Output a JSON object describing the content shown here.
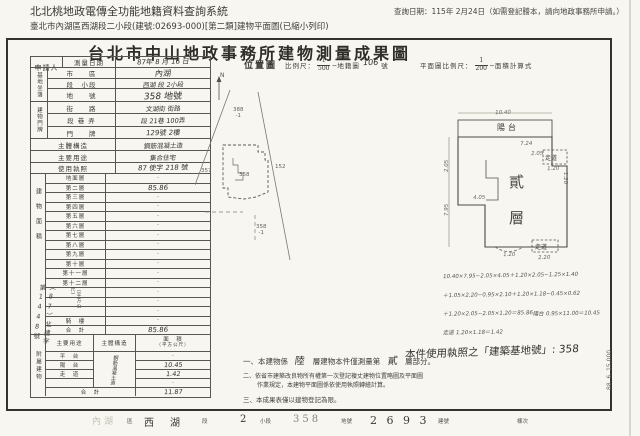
{
  "colors": {
    "ink": "#34322c",
    "paper": "#f7f6f1",
    "line": "#5a564d"
  },
  "page": {
    "system_title": "北北桃地政電傳全功能地籍資料查詢系統",
    "query_date": "查詢日期：115年 2月24日（如需登記謄本，請向地政事務所申請。）",
    "print_line": "臺北市內湖區西湖段二小段(建號:02693-000)[第二類]建物平面圖(已縮小列印)",
    "form_code": "88. 6. 15,000"
  },
  "title": "台北市中山地政事務所建物測量成果圖",
  "info": {
    "applicant_label": "申請人",
    "survey_date_label": "測量日期",
    "survey_date": "87年 8 月 16 日",
    "site_group": "基地坐落",
    "city_label": "市　　區",
    "city": "內湖",
    "section_label": "段　小段",
    "section": "西湖 段 2小段",
    "parcel_label": "地　　號",
    "parcel": "358 地號",
    "door_group": "建物門牌",
    "street_label": "街　　路",
    "street": "文湖街 街路",
    "lane_label": "段 巷 弄",
    "lane": "段 21巷 100弄",
    "door_label": "門　　牌",
    "door": "129號 2樓",
    "structure_label": "主體構造",
    "structure": "鋼筋混凝土造",
    "use_label": "主要用途",
    "use": "集合住宅",
    "license_label": "使用執照",
    "license": "87 使字 218 號"
  },
  "floors": {
    "group": "建物面積",
    "unit": "（平方公尺）",
    "stamp": "（87）北建字第1448號",
    "rows": [
      {
        "label": "地面層",
        "value": "·",
        "hand": false
      },
      {
        "label": "第二層",
        "value": "85.86",
        "hand": true
      },
      {
        "label": "第三層",
        "value": "·",
        "hand": false
      },
      {
        "label": "第四層",
        "value": "·",
        "hand": false
      },
      {
        "label": "第五層",
        "value": "·",
        "hand": false
      },
      {
        "label": "第六層",
        "value": "·",
        "hand": false
      },
      {
        "label": "第七層",
        "value": "·",
        "hand": false
      },
      {
        "label": "第八層",
        "value": "·",
        "hand": false
      },
      {
        "label": "第九層",
        "value": "·",
        "hand": false
      },
      {
        "label": "第十層",
        "value": "·",
        "hand": false
      },
      {
        "label": "第十一層",
        "value": "·",
        "hand": false
      },
      {
        "label": "第十二層",
        "value": "·",
        "hand": false
      },
      {
        "label": "",
        "value": "·",
        "hand": false
      },
      {
        "label": "",
        "value": "·",
        "hand": false
      },
      {
        "label": "",
        "value": "·",
        "hand": false
      },
      {
        "label": "騎　樓",
        "value": "·",
        "hand": false
      },
      {
        "label": "合　計",
        "value": "85.86",
        "hand": true
      }
    ]
  },
  "attached": {
    "group": "附屬建物",
    "headers": [
      "主要用途",
      "主體構造",
      "面　積"
    ],
    "area_unit": "（平方公尺）",
    "structure_vertical": "鋼筋混凝土造",
    "rows": [
      {
        "use": "平　台",
        "value": "·",
        "hand": false
      },
      {
        "use": "陽　台",
        "value": "10.45",
        "hand": true
      },
      {
        "use": "走　道",
        "value": "1.42",
        "hand": true
      },
      {
        "use": "",
        "value": "·",
        "hand": false
      },
      {
        "use": "合　計",
        "value": "11.87",
        "hand": true
      }
    ]
  },
  "location_map": {
    "header_label": "位置圖",
    "scale_label": "比例尺：",
    "scale_num": "1",
    "scale_den": "500",
    "map_ref_label": "─地籍圖",
    "map_ref": "106",
    "map_ref_suffix": "號",
    "north": "N",
    "parcels": [
      {
        "line1": "388",
        "line2": "-1",
        "x": 38,
        "y": 23
      },
      {
        "line1": "357",
        "line2": "",
        "x": 6,
        "y": 84
      },
      {
        "line1": "358",
        "line2": "",
        "x": 44,
        "y": 88
      },
      {
        "line1": "152",
        "line2": "",
        "x": 80,
        "y": 80
      },
      {
        "line1": "358",
        "line2": "-1",
        "x": 61,
        "y": 140
      }
    ]
  },
  "floor_plan": {
    "header_label": "平面圖比例尺：",
    "scale_num": "1",
    "scale_den": "200",
    "calc_label": "─面積計算式",
    "balcony_label": "陽台",
    "floor_char_1": "貳",
    "floor_char_2": "層",
    "corridor_label_right": "走道",
    "corridor_label_bottom": "走道",
    "dims": [
      {
        "t": "10.40",
        "x": 60,
        "y": 15,
        "r": 0
      },
      {
        "t": "7.24",
        "x": 85,
        "y": 46,
        "r": 0
      },
      {
        "t": "2.05",
        "x": 96,
        "y": 56,
        "r": 0
      },
      {
        "t": "1.20",
        "x": 112,
        "y": 71,
        "r": 0
      },
      {
        "t": "1.20",
        "x": 124,
        "y": 80,
        "r": 90
      },
      {
        "t": "2.05",
        "x": 6,
        "y": 68,
        "r": -90
      },
      {
        "t": "7.95",
        "x": 6,
        "y": 112,
        "r": -90
      },
      {
        "t": "4.05",
        "x": 38,
        "y": 100,
        "r": 0
      },
      {
        "t": "1.20",
        "x": 68,
        "y": 157,
        "r": 0
      },
      {
        "t": "2.20",
        "x": 103,
        "y": 160,
        "r": 0
      }
    ],
    "calc_lines": [
      "10.40×7.95−2.05×4.05＋1.20×2.05−1.25×1.40",
      "＋1.05×2.20−0.95×2.10＋1.20×1.18−0.45×0.62",
      "＋1.20×2.05−2.05×1.20＝85.86",
      "陽台 0.95×11.00＝10.45",
      "走道 1.20×1.18＝1.42"
    ]
  },
  "notes": {
    "n1a": "一、本建物係",
    "n1_hand1": "陸",
    "n1b": "層建物本件僅測量第",
    "n1_hand2": "貳",
    "n1c": "層部分。",
    "n2a": "二、依省市建築改良物所有權第一次登記複丈建物位置略圖及平面圖",
    "n2b": "作業規定，本建物平面圖係依使用執照轉繪計算。",
    "n3": "三、本成果表僅以建物登記為限。",
    "hand_note": "本件使用執照之「建築基地號」: 358"
  },
  "footer": {
    "fields": [
      {
        "value": "內湖",
        "label": "區",
        "vx": 92,
        "lx": 127,
        "vcls": "faint",
        "vsize": 9
      },
      {
        "value": "西　湖",
        "label": "段",
        "vx": 144,
        "lx": 202,
        "vcls": "",
        "vsize": 10
      },
      {
        "value": "2",
        "label": "小段",
        "vx": 240,
        "lx": 260,
        "vcls": "",
        "vsize": 10
      },
      {
        "value": "358",
        "label": "地號",
        "vx": 293,
        "lx": 341,
        "vcls": "gray-type",
        "vsize": 10
      },
      {
        "value": "2 6 9 3",
        "label": "建號",
        "vx": 370,
        "lx": 438,
        "vcls": "",
        "vsize": 11
      },
      {
        "value": "",
        "label": "棟次",
        "vx": 500,
        "lx": 517,
        "vcls": "",
        "vsize": 9
      }
    ]
  }
}
